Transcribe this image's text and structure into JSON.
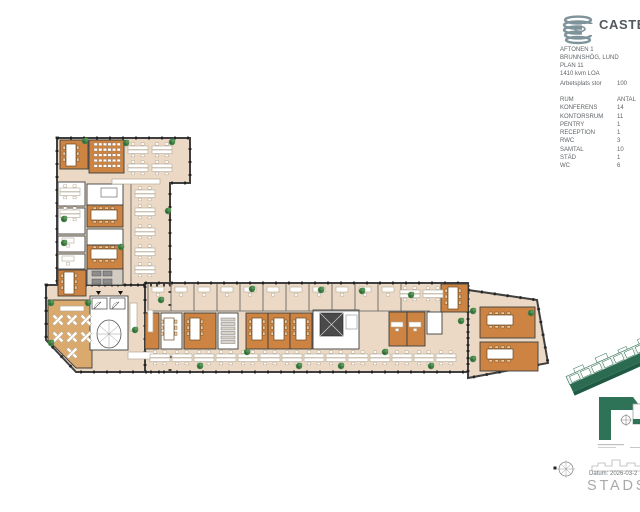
{
  "panel": {
    "logo_text": "CASTEL",
    "project_lines": [
      "AFTONEN 1",
      "BRUNNSHÖG, LUND",
      "PLAN 11",
      "1410 kvm LOA"
    ],
    "workplace_label": "Arbetsplats stor",
    "workplace_value": "100",
    "room_table": {
      "header": {
        "room": "RUM",
        "count": "ANTAL"
      },
      "rows": [
        [
          "KONFERENS",
          "14"
        ],
        [
          "KONTORSRUM",
          "11"
        ],
        [
          "PENTRY",
          "1"
        ],
        [
          "RECEPTION",
          "1"
        ],
        [
          "RWC",
          "3"
        ],
        [
          "SAMTAL",
          "10"
        ],
        [
          "STÄD",
          "1"
        ],
        [
          "WC",
          "6"
        ]
      ]
    },
    "datum_label": "Datum: 2026-03-2",
    "watermark": "STADSTU"
  },
  "colors": {
    "wall": "#3f3f3f",
    "floor": "#ebd9c5",
    "cafe": "#d9a96e",
    "orange": "#cd8342",
    "white_room": "#ffffff",
    "gray_room": "#d2cbc1",
    "plant": "#3f7d44",
    "brand_green": "#2a6b52",
    "logo_gray": "#7e939a"
  },
  "floorplan": {
    "footprint": [
      "57,138 190,138 190,183 170,183 170,285 57,285",
      "46,285 170,285 170,372 76,372 46,340",
      "145,283 468,283 468,372 145,372",
      "468,290 537,300 548,363 468,378"
    ],
    "cafe": "48,300 92,300 92,368 76,368 48,340",
    "rooms": [
      {
        "x": 60,
        "y": 140,
        "w": 28,
        "h": 29,
        "f": "o"
      },
      {
        "x": 89,
        "y": 140,
        "w": 35,
        "h": 33,
        "f": "o"
      },
      {
        "x": 87,
        "y": 184,
        "w": 36,
        "h": 21,
        "f": "w"
      },
      {
        "x": 87,
        "y": 205,
        "w": 36,
        "h": 22,
        "f": "o"
      },
      {
        "x": 87,
        "y": 229,
        "w": 36,
        "h": 16,
        "f": "w"
      },
      {
        "x": 87,
        "y": 245,
        "w": 36,
        "h": 24,
        "f": "o"
      },
      {
        "x": 87,
        "y": 269,
        "w": 36,
        "h": 16,
        "f": "g"
      },
      {
        "x": 58,
        "y": 182,
        "w": 27,
        "h": 24,
        "f": "w"
      },
      {
        "x": 58,
        "y": 208,
        "w": 27,
        "h": 26,
        "f": "w"
      },
      {
        "x": 58,
        "y": 236,
        "w": 27,
        "h": 16,
        "f": "w"
      },
      {
        "x": 58,
        "y": 254,
        "w": 27,
        "h": 15,
        "f": "w"
      },
      {
        "x": 58,
        "y": 270,
        "w": 28,
        "h": 26,
        "f": "o"
      },
      {
        "x": 90,
        "y": 296,
        "w": 38,
        "h": 54,
        "f": "w"
      },
      {
        "x": 145,
        "y": 313,
        "w": 14,
        "h": 36,
        "f": "o"
      },
      {
        "x": 161,
        "y": 313,
        "w": 21,
        "h": 36,
        "f": "w"
      },
      {
        "x": 184,
        "y": 313,
        "w": 32,
        "h": 36,
        "f": "o"
      },
      {
        "x": 218,
        "y": 313,
        "w": 20,
        "h": 36,
        "f": "w"
      },
      {
        "x": 246,
        "y": 313,
        "w": 22,
        "h": 36,
        "f": "o"
      },
      {
        "x": 268,
        "y": 313,
        "w": 22,
        "h": 36,
        "f": "o"
      },
      {
        "x": 290,
        "y": 313,
        "w": 22,
        "h": 36,
        "f": "o"
      },
      {
        "x": 313,
        "y": 310,
        "w": 46,
        "h": 39,
        "f": "w"
      },
      {
        "x": 389,
        "y": 312,
        "w": 18,
        "h": 34,
        "f": "o"
      },
      {
        "x": 407,
        "y": 312,
        "w": 18,
        "h": 34,
        "f": "o"
      },
      {
        "x": 427,
        "y": 312,
        "w": 15,
        "h": 22,
        "f": "w"
      },
      {
        "x": 441,
        "y": 284,
        "w": 27,
        "h": 28,
        "f": "o"
      },
      {
        "x": 480,
        "y": 307,
        "w": 55,
        "h": 31,
        "f": "o"
      },
      {
        "x": 480,
        "y": 342,
        "w": 58,
        "h": 29,
        "f": "o"
      }
    ],
    "furn_rects": [
      [
        130,
        303,
        7,
        28
      ],
      [
        148,
        310,
        5,
        22
      ],
      [
        128,
        352,
        26,
        7
      ],
      [
        112,
        179,
        48,
        5
      ],
      [
        60,
        306,
        24,
        5
      ]
    ],
    "lines": [
      [
        148,
        311,
        430,
        311
      ],
      [
        131,
        184,
        131,
        284
      ],
      [
        148,
        284,
        148,
        311
      ],
      [
        171,
        284,
        171,
        311
      ],
      [
        194,
        284,
        194,
        311
      ],
      [
        217,
        284,
        217,
        311
      ],
      [
        240,
        284,
        240,
        311
      ],
      [
        263,
        284,
        263,
        311
      ],
      [
        286,
        284,
        286,
        311
      ],
      [
        309,
        284,
        309,
        311
      ],
      [
        332,
        284,
        332,
        311
      ],
      [
        355,
        284,
        355,
        311
      ],
      [
        378,
        284,
        378,
        311
      ],
      [
        401,
        284,
        401,
        311
      ]
    ],
    "uses": [
      [
        "seatrows",
        94,
        143
      ],
      [
        "confv",
        66,
        144
      ],
      [
        "dp",
        128,
        144
      ],
      [
        "dp",
        152,
        144
      ],
      [
        "dp",
        128,
        162
      ],
      [
        "dp",
        152,
        162
      ],
      [
        "dp",
        60,
        186
      ],
      [
        "dp",
        60,
        208
      ],
      [
        "d1",
        62,
        238
      ],
      [
        "d1",
        62,
        256
      ],
      [
        "tbl",
        101,
        188
      ],
      [
        "conf",
        91,
        210
      ],
      [
        "conf",
        91,
        249
      ],
      [
        "gdesk",
        92,
        271
      ],
      [
        "confv",
        64,
        272
      ],
      [
        "dp",
        135,
        188
      ],
      [
        "dp",
        135,
        206
      ],
      [
        "dp",
        135,
        226
      ],
      [
        "dp",
        135,
        246
      ],
      [
        "dp",
        135,
        264
      ],
      [
        "d1",
        152,
        287
      ],
      [
        "d1",
        175,
        287
      ],
      [
        "d1",
        198,
        287
      ],
      [
        "d1",
        221,
        287
      ],
      [
        "d1",
        244,
        287
      ],
      [
        "d1",
        267,
        287
      ],
      [
        "d1",
        290,
        287
      ],
      [
        "d1",
        313,
        287
      ],
      [
        "d1",
        336,
        287
      ],
      [
        "d1",
        359,
        287
      ],
      [
        "d1",
        382,
        287
      ],
      [
        "dp",
        400,
        288
      ],
      [
        "dp",
        423,
        288
      ],
      [
        "confv",
        448,
        287
      ],
      [
        "confv",
        164,
        318
      ],
      [
        "confv",
        190,
        318
      ],
      [
        "shelf",
        221,
        318
      ],
      [
        "confv",
        252,
        318
      ],
      [
        "confv",
        274,
        318
      ],
      [
        "confv",
        296,
        318
      ],
      [
        "d1",
        391,
        322
      ],
      [
        "d1",
        409,
        322
      ],
      [
        "conf",
        487,
        315
      ],
      [
        "conf",
        487,
        349
      ],
      [
        "dp",
        150,
        352
      ],
      [
        "dp",
        172,
        352
      ],
      [
        "dp",
        194,
        352
      ],
      [
        "dp",
        216,
        352
      ],
      [
        "dp",
        238,
        352
      ],
      [
        "dp",
        260,
        352
      ],
      [
        "dp",
        282,
        352
      ],
      [
        "dp",
        304,
        352
      ],
      [
        "dp",
        326,
        352
      ],
      [
        "dp",
        348,
        352
      ],
      [
        "dp",
        370,
        352
      ],
      [
        "dp",
        392,
        352
      ],
      [
        "dp",
        414,
        352
      ],
      [
        "dp",
        436,
        352
      ],
      [
        "xt",
        58,
        320
      ],
      [
        "xt",
        72,
        320
      ],
      [
        "xt",
        86,
        320
      ],
      [
        "xt",
        58,
        337
      ],
      [
        "xt",
        72,
        337
      ],
      [
        "xt",
        86,
        337
      ],
      [
        "xt",
        72,
        353
      ]
    ],
    "plants": [
      [
        85,
        141
      ],
      [
        126,
        143
      ],
      [
        172,
        142
      ],
      [
        64,
        219
      ],
      [
        64,
        243
      ],
      [
        121,
        247
      ],
      [
        168,
        211
      ],
      [
        51,
        303
      ],
      [
        88,
        303
      ],
      [
        51,
        343
      ],
      [
        135,
        330
      ],
      [
        161,
        300
      ],
      [
        200,
        366
      ],
      [
        247,
        352
      ],
      [
        299,
        366
      ],
      [
        341,
        366
      ],
      [
        385,
        352
      ],
      [
        431,
        366
      ],
      [
        411,
        295
      ],
      [
        461,
        321
      ],
      [
        473,
        311
      ],
      [
        531,
        313
      ],
      [
        473,
        359
      ],
      [
        321,
        290
      ],
      [
        362,
        291
      ],
      [
        252,
        289
      ]
    ]
  }
}
